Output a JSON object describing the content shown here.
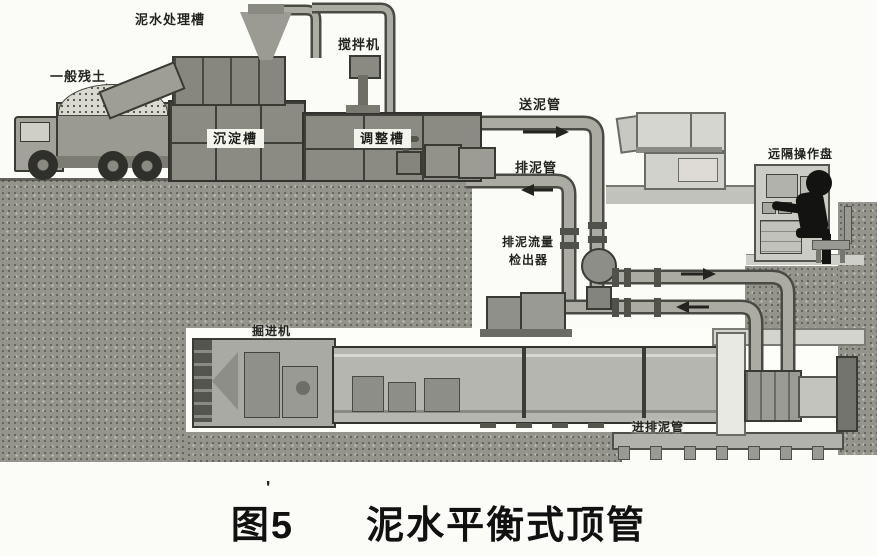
{
  "caption": {
    "prefix": "图5",
    "title": "泥水平衡式顶管",
    "tick": "'"
  },
  "labels": {
    "soil": "一般残土",
    "slurry_treatment_tank": "泥水处理槽",
    "mixer": "搅拌机",
    "sedimentation_tank": "沉淀槽",
    "adjustment_tank": "调整槽",
    "feed_pipe": "送泥管",
    "discharge_pipe": "排泥管",
    "flow_detector_line1": "排泥流量",
    "flow_detector_line2": "检出器",
    "remote_panel": "远隔操作盘",
    "machine": "掘进机",
    "pit_pipes": "进排泥管"
  },
  "flow": {
    "feed_direction": "right",
    "discharge_direction": "left",
    "pit_feed_direction": "right",
    "pit_discharge_direction": "left"
  },
  "colors": {
    "background": "#fbfbf8",
    "earth": "#94948c",
    "tank": "#8b8b83",
    "pipe": "#abaaa3",
    "pipe_outline": "#4a4a44",
    "ink": "#1c1c1a",
    "operator_silhouette": "#131311"
  }
}
